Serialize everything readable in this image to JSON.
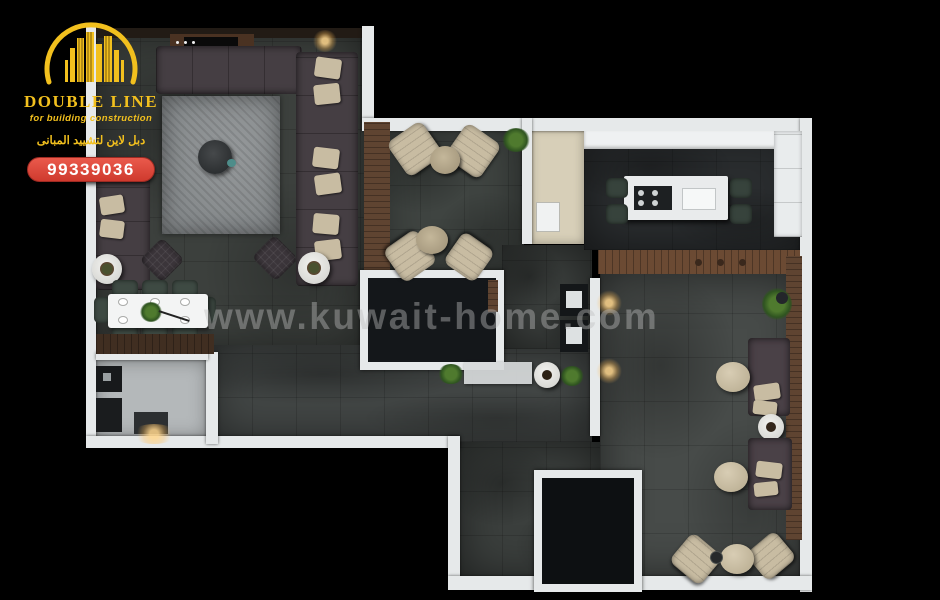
{
  "brand": {
    "name": "DOUBLE LINE",
    "tagline": "for building construction",
    "tagline_arabic": "دبل لاين لتشييد المبانى",
    "phone": "99339036"
  },
  "watermark": {
    "text": "www.kuwait-home.com"
  },
  "colors": {
    "bg": "#000000",
    "wall": "#E6E9EA",
    "wood": "#5F4431",
    "wood2": "#6B4A33",
    "beige": "#C8BCA2",
    "sofa": "#453E43",
    "green": "#3E4A43",
    "brand_gold": "#F2C01E",
    "badge_red": "#E2453C"
  },
  "floorplan": {
    "view": "top-down 3d apartment render",
    "rooms": [
      "living-lounge",
      "dining-area",
      "seating-nook",
      "kitchen",
      "family-majlis",
      "hallway",
      "utility-room",
      "bathroom",
      "storage-room"
    ]
  }
}
